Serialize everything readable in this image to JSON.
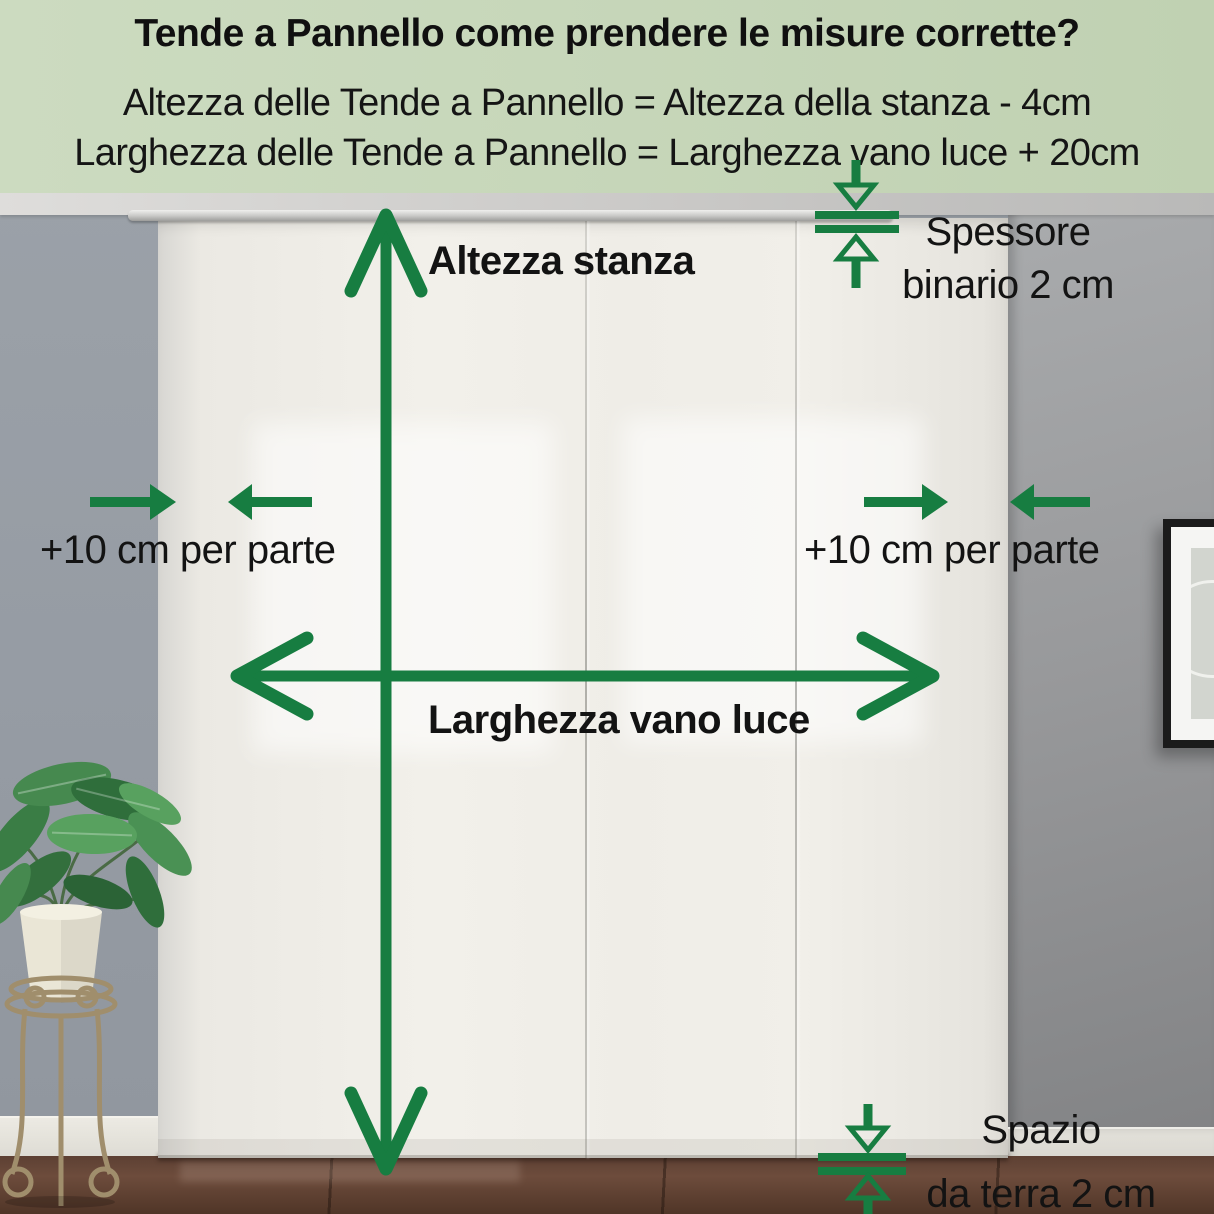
{
  "header": {
    "title": "Tende a Pannello come prendere le misure corrette?",
    "formula_height": "Altezza delle Tende a Pannello = Altezza della stanza - 4cm",
    "formula_width": "Larghezza delle Tende a Pannello = Larghezza vano luce + 20cm"
  },
  "labels": {
    "room_height": "Altezza stanza",
    "opening_width": "Larghezza vano luce",
    "side_margin_left": "+10 cm per parte",
    "side_margin_right": "+10 cm per parte",
    "track_thickness_line1": "Spessore",
    "track_thickness_line2": "binario 2 cm",
    "floor_gap_line1": "Spazio",
    "floor_gap_line2": "da terra 2 cm"
  },
  "colors": {
    "accent_green": "#177d41",
    "header_background": "#c7d7ba",
    "text": "#141414"
  }
}
